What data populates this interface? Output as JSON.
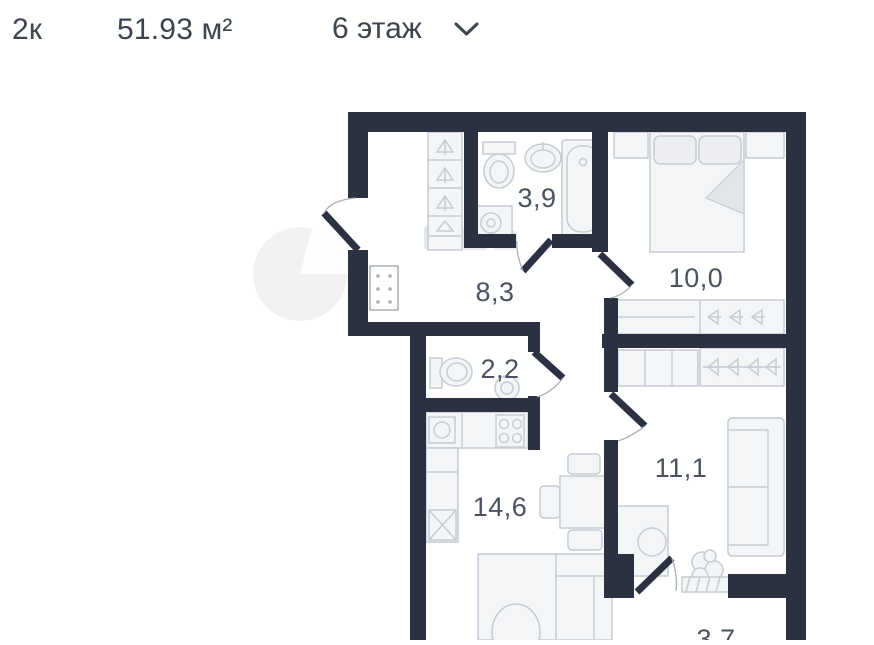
{
  "header": {
    "rooms_label": "2к",
    "area_label": "51.93 м²",
    "floor_label": "6 этаж",
    "floor_dropdown_icon": "chevron-down"
  },
  "floorplan": {
    "wall_color": "#2b3140",
    "furniture_outline_color": "#c6ccd3",
    "label_color": "#4a5160",
    "rooms": [
      {
        "name": "bathroom",
        "area": "3,9"
      },
      {
        "name": "hallway",
        "area": "8,3"
      },
      {
        "name": "bedroom",
        "area": "10,0"
      },
      {
        "name": "wc",
        "area": "2,2"
      },
      {
        "name": "kitchen-living-room",
        "area": "14,6"
      },
      {
        "name": "room",
        "area": "11,1"
      },
      {
        "name": "balcony",
        "area": "3,7"
      }
    ],
    "watermark_present": true
  }
}
